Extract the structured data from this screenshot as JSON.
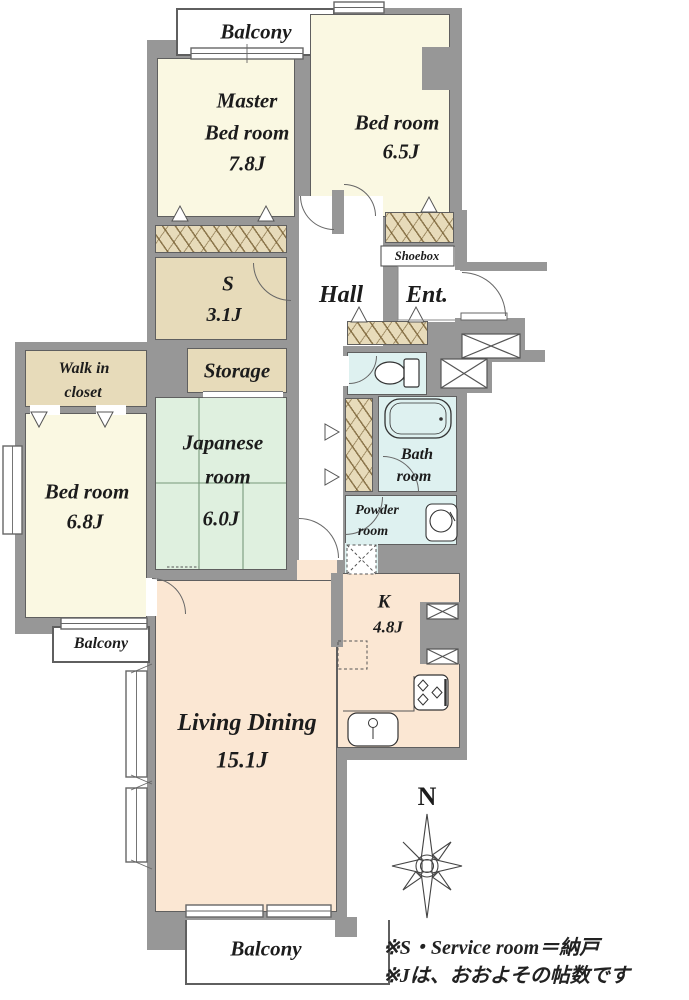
{
  "plan": {
    "rooms": {
      "balcony_top": {
        "label": "Balcony"
      },
      "master_bedroom": {
        "line1": "Master",
        "line2": "Bed room",
        "size": "7.8J"
      },
      "bedroom_65": {
        "line1": "Bed room",
        "size": "6.5J"
      },
      "service_room": {
        "line1": "S",
        "size": "3.1J"
      },
      "hall": {
        "label": "Hall"
      },
      "entrance": {
        "label": "Ent."
      },
      "shoebox": {
        "label": "Shoebox"
      },
      "storage": {
        "label": "Storage"
      },
      "walk_in_closet": {
        "line1": "Walk in",
        "line2": "closet"
      },
      "bedroom_68": {
        "line1": "Bed room",
        "size": "6.8J"
      },
      "japanese_room": {
        "line1": "Japanese",
        "line2": "room",
        "size": "6.0J"
      },
      "bathroom": {
        "line1": "Bath",
        "line2": "room"
      },
      "powder_room": {
        "line1": "Powder",
        "line2": "room"
      },
      "kitchen": {
        "line1": "K",
        "size": "4.8J"
      },
      "living_dining": {
        "line1": "Living Dining",
        "size": "15.1J"
      },
      "balcony_left": {
        "label": "Balcony"
      },
      "balcony_bottom": {
        "label": "Balcony"
      }
    },
    "compass": {
      "north": "N"
    },
    "legend": {
      "line1": "※S・Service room＝納戸",
      "line2": "※Jは、おおよその帖数です"
    }
  },
  "colors": {
    "wall": "#979797",
    "room_cream": "#faf8e2",
    "closet_tan": "#e7dbba",
    "tatami_green": "#dff0df",
    "wet_area_blue": "#def1f0",
    "living_peach": "#fbe7d3"
  }
}
